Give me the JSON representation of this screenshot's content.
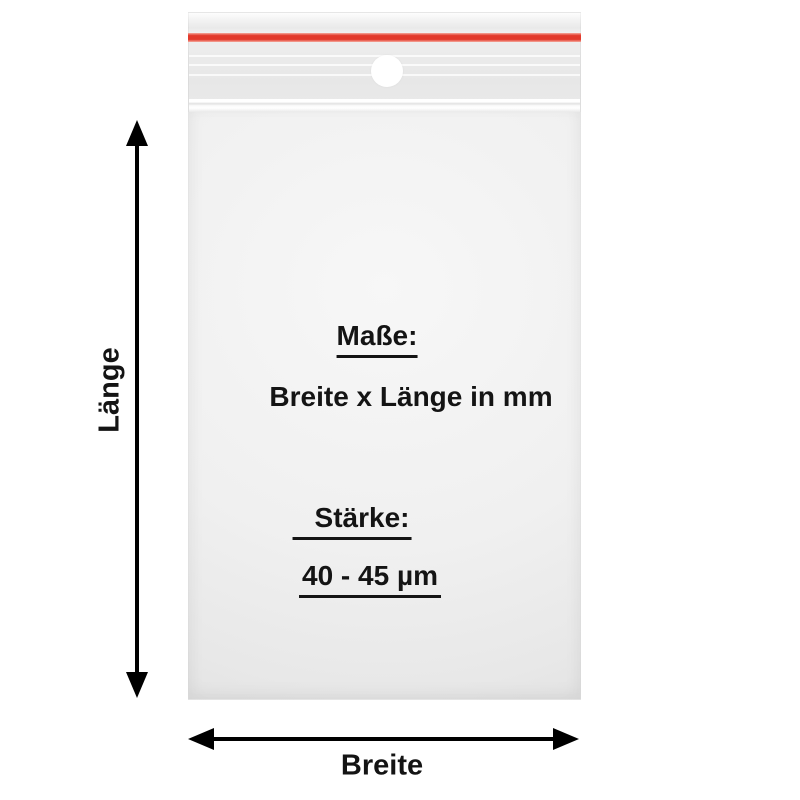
{
  "product_diagram": {
    "type": "zip-lock-bag-dimension-diagram",
    "bag_print": {
      "dimensions_title": "Maße:",
      "dimensions_value": "Breite x Länge in mm",
      "thickness_title": "Stärke:",
      "thickness_value": "40 - 45 µm"
    },
    "dimension_labels": {
      "length_label": "Länge",
      "width_label": "Breite"
    },
    "features": {
      "seal": "red-pressure-seal-line",
      "hole": "round-hang-hole"
    }
  },
  "colors": {
    "seal_red": "#e2392b",
    "seal_red_light": "#f5a99d",
    "bag_light": "#f6f6f6",
    "bag_mid": "#ececec",
    "bag_dark": "#e3e3e3",
    "text": "#141414",
    "arrow": "#000000",
    "background": "#ffffff"
  }
}
